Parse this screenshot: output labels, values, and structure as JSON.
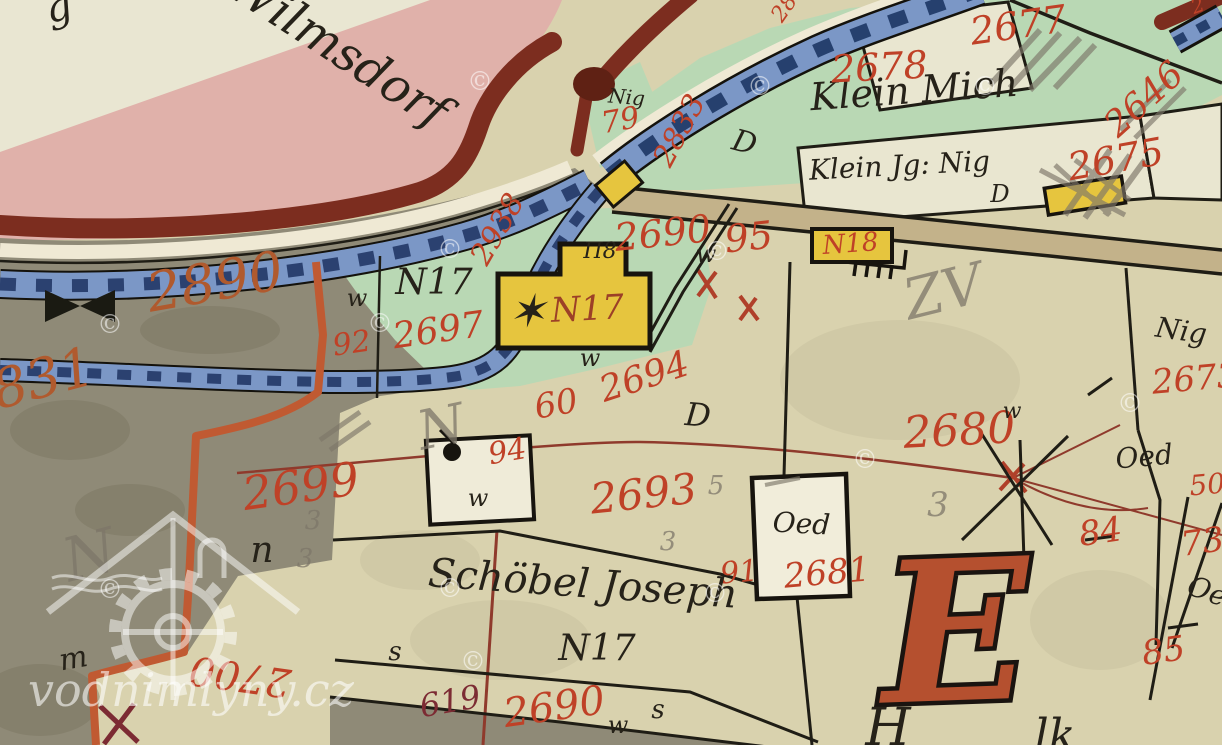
{
  "palette": {
    "parchment": "#d9d2ae",
    "parchment_light": "#e9e6d2",
    "pink": "#e0b1aa",
    "boundary_maroon": "#7c2d1f",
    "blob_brown": "#5f2114",
    "stream_blue": "#7b97c6",
    "stream_dark": "#2b4170",
    "stream_edge": "#14120c",
    "white_bank": "#efe9d4",
    "meadow_green": "#b9d8b4",
    "gray_land": "#8f8a77",
    "building_yellow": "#e6c53e",
    "building_white": "#f1edda",
    "road_tan": "#c3b28a",
    "orange_boundary": "#c05a32",
    "thin_red_line": "#8f3a2c",
    "parcel_red": "#bf4127",
    "orange_num": "#b05a2e",
    "dark_red_num": "#7c2b33",
    "red_brown": "#9c4027",
    "big_e": "#b5502f",
    "ink": "#262219",
    "pencil": "#7d7669"
  },
  "watermark": {
    "site": "vodnimlyny.cz",
    "symbol": "©",
    "positions": [
      [
        480,
        90
      ],
      [
        760,
        95
      ],
      [
        985,
        95
      ],
      [
        450,
        258
      ],
      [
        717,
        260
      ],
      [
        110,
        333
      ],
      [
        380,
        332
      ],
      [
        1130,
        412
      ],
      [
        865,
        468
      ],
      [
        450,
        597
      ],
      [
        715,
        602
      ],
      [
        110,
        598
      ],
      [
        473,
        670
      ]
    ]
  },
  "labels": [
    {
      "n": "script-fragment-top-left",
      "t": "g",
      "x": 62,
      "y": 20,
      "s": 40,
      "r": -15,
      "c": "ink"
    },
    {
      "n": "place-name-wilmsdorf",
      "t": "Wilmsdorf",
      "x": 330,
      "y": 62,
      "s": 48,
      "r": 33,
      "c": "ink"
    },
    {
      "n": "place-name-klein-mich",
      "t": "Klein Mich",
      "x": 915,
      "y": 103,
      "s": 38,
      "r": -4,
      "c": "ink"
    },
    {
      "n": "place-name-klein-jg-nig",
      "t": "Klein Jg: Nig",
      "x": 900,
      "y": 175,
      "s": 28,
      "r": -3,
      "c": "ink"
    },
    {
      "n": "letter-d-klein-parcel",
      "t": "D",
      "x": 1000,
      "y": 202,
      "s": 24,
      "r": 0,
      "c": "ink"
    },
    {
      "n": "label-nig-junction",
      "t": "Nig",
      "x": 626,
      "y": 104,
      "s": 20,
      "r": 5,
      "c": "ink"
    },
    {
      "n": "parcel-number-79",
      "t": "79",
      "x": 622,
      "y": 130,
      "s": 30,
      "r": -10,
      "c": "parcel_red"
    },
    {
      "n": "parcel-number-2833",
      "t": "2833",
      "x": 688,
      "y": 135,
      "s": 30,
      "r": -62,
      "c": "parcel_red"
    },
    {
      "n": "parcel-number-2938",
      "t": "2938",
      "x": 506,
      "y": 234,
      "s": 30,
      "r": -60,
      "c": "parcel_red"
    },
    {
      "n": "parcel-number-2677",
      "t": "2677",
      "x": 1020,
      "y": 38,
      "s": 38,
      "r": -8,
      "c": "parcel_red"
    },
    {
      "n": "parcel-number-2678",
      "t": "2678",
      "x": 880,
      "y": 80,
      "s": 38,
      "r": -3,
      "c": "parcel_red"
    },
    {
      "n": "parcel-number-2646",
      "t": "2646",
      "x": 1152,
      "y": 108,
      "s": 36,
      "r": -42,
      "c": "parcel_red"
    },
    {
      "n": "parcel-number-2675",
      "t": "2675",
      "x": 1118,
      "y": 172,
      "s": 38,
      "r": -10,
      "c": "parcel_red"
    },
    {
      "n": "letter-d-junction-meadow",
      "t": "D",
      "x": 742,
      "y": 152,
      "s": 30,
      "r": 15,
      "c": "ink"
    },
    {
      "n": "parcel-number-2690-mid",
      "t": "2690",
      "x": 664,
      "y": 246,
      "s": 38,
      "r": -6,
      "c": "parcel_red"
    },
    {
      "n": "parcel-number-95",
      "t": "95",
      "x": 750,
      "y": 250,
      "s": 38,
      "r": -6,
      "c": "parcel_red"
    },
    {
      "n": "letter-w-mid",
      "t": "w",
      "x": 706,
      "y": 262,
      "s": 24,
      "r": 0,
      "c": "ink"
    },
    {
      "n": "house-number-n18",
      "t": "N18",
      "x": 851,
      "y": 252,
      "s": 26,
      "r": -4,
      "c": "parcel_red"
    },
    {
      "n": "parcel-number-2890",
      "t": "2890",
      "x": 218,
      "y": 300,
      "s": 54,
      "r": -10,
      "c": "orange_num"
    },
    {
      "n": "parcel-number-831",
      "t": "831",
      "x": 48,
      "y": 396,
      "s": 54,
      "r": -15,
      "c": "orange_num"
    },
    {
      "n": "house-number-n17-meadow",
      "t": "N17",
      "x": 434,
      "y": 294,
      "s": 36,
      "r": 0,
      "c": "ink"
    },
    {
      "n": "parcel-number-2697",
      "t": "2697",
      "x": 440,
      "y": 342,
      "s": 36,
      "r": -8,
      "c": "parcel_red"
    },
    {
      "n": "parcel-number-92",
      "t": "92",
      "x": 353,
      "y": 353,
      "s": 30,
      "r": -8,
      "c": "parcel_red"
    },
    {
      "n": "letter-w-left",
      "t": "w",
      "x": 357,
      "y": 306,
      "s": 24,
      "r": 0,
      "c": "ink"
    },
    {
      "n": "house-star-mark",
      "t": "✶",
      "x": 527,
      "y": 327,
      "s": 46,
      "r": 0,
      "c": "ink"
    },
    {
      "n": "house-number-n17-building",
      "t": "N17",
      "x": 588,
      "y": 320,
      "s": 34,
      "r": -3,
      "c": "red_brown"
    },
    {
      "n": "house-mark-n8",
      "t": "Π8",
      "x": 600,
      "y": 258,
      "s": 22,
      "r": 0,
      "c": "ink"
    },
    {
      "n": "letter-w-below-house",
      "t": "w",
      "x": 590,
      "y": 366,
      "s": 24,
      "r": 0,
      "c": "ink"
    },
    {
      "n": "parcel-number-2694",
      "t": "2694",
      "x": 648,
      "y": 388,
      "s": 36,
      "r": -18,
      "c": "parcel_red"
    },
    {
      "n": "parcel-number-60",
      "t": "60",
      "x": 558,
      "y": 415,
      "s": 34,
      "r": -10,
      "c": "parcel_red"
    },
    {
      "n": "letter-d-2680",
      "t": "D",
      "x": 697,
      "y": 426,
      "s": 32,
      "r": 5,
      "c": "ink"
    },
    {
      "n": "parcel-number-2680",
      "t": "2680",
      "x": 960,
      "y": 445,
      "s": 44,
      "r": -3,
      "c": "parcel_red"
    },
    {
      "n": "pencil-3-2680",
      "t": "3",
      "x": 938,
      "y": 516,
      "s": 34,
      "r": 0,
      "c": "pencil",
      "cls": "pencil"
    },
    {
      "n": "pencil-n-left",
      "t": "N",
      "x": 95,
      "y": 575,
      "s": 60,
      "r": -15,
      "c": "pencil",
      "cls": "pencil"
    },
    {
      "n": "pencil-n-mid",
      "t": "N",
      "x": 445,
      "y": 445,
      "s": 54,
      "r": -12,
      "c": "pencil",
      "cls": "pencil"
    },
    {
      "n": "pencil-zv",
      "t": "ZV",
      "x": 948,
      "y": 310,
      "s": 56,
      "r": -14,
      "c": "pencil",
      "cls": "pencil"
    },
    {
      "n": "parcel-number-94",
      "t": "94",
      "x": 509,
      "y": 461,
      "s": 30,
      "r": -10,
      "c": "parcel_red"
    },
    {
      "n": "letter-w-square-building",
      "t": "w",
      "x": 478,
      "y": 506,
      "s": 24,
      "r": 0,
      "c": "ink"
    },
    {
      "n": "parcel-number-2699",
      "t": "2699",
      "x": 303,
      "y": 502,
      "s": 46,
      "r": -8,
      "c": "parcel_red"
    },
    {
      "n": "letter-n-2699",
      "t": "n",
      "x": 262,
      "y": 562,
      "s": 36,
      "r": 0,
      "c": "ink"
    },
    {
      "n": "pencil-3-a",
      "t": "3",
      "x": 313,
      "y": 529,
      "s": 26,
      "r": 0,
      "c": "pencil",
      "cls": "pencil"
    },
    {
      "n": "pencil-3-b",
      "t": "3",
      "x": 305,
      "y": 567,
      "s": 26,
      "r": 0,
      "c": "pencil",
      "cls": "pencil"
    },
    {
      "n": "pencil-3-c",
      "t": "3",
      "x": 668,
      "y": 550,
      "s": 26,
      "r": 0,
      "c": "pencil",
      "cls": "pencil"
    },
    {
      "n": "pencil-5",
      "t": "5",
      "x": 716,
      "y": 494,
      "s": 26,
      "r": 0,
      "c": "pencil",
      "cls": "pencil"
    },
    {
      "n": "parcel-number-2693",
      "t": "2693",
      "x": 645,
      "y": 508,
      "s": 42,
      "r": -6,
      "c": "parcel_red"
    },
    {
      "n": "building-label-oed",
      "t": "Oed",
      "x": 801,
      "y": 533,
      "s": 28,
      "r": 3,
      "c": "ink"
    },
    {
      "n": "parcel-number-91",
      "t": "91",
      "x": 740,
      "y": 582,
      "s": 30,
      "r": -5,
      "c": "parcel_red"
    },
    {
      "n": "parcel-number-2681",
      "t": "2681",
      "x": 828,
      "y": 584,
      "s": 34,
      "r": -5,
      "c": "parcel_red"
    },
    {
      "n": "label-oed-right",
      "t": "Oed",
      "x": 1145,
      "y": 466,
      "s": 28,
      "r": -5,
      "c": "ink"
    },
    {
      "n": "parcel-number-50",
      "t": "50",
      "x": 1208,
      "y": 494,
      "s": 28,
      "r": -5,
      "c": "parcel_red"
    },
    {
      "n": "label-nig-right",
      "t": "Nig",
      "x": 1180,
      "y": 340,
      "s": 28,
      "r": 8,
      "c": "ink"
    },
    {
      "n": "parcel-number-2673",
      "t": "2673",
      "x": 1196,
      "y": 390,
      "s": 34,
      "r": -5,
      "c": "parcel_red"
    },
    {
      "n": "parcel-number-84",
      "t": "84",
      "x": 1102,
      "y": 543,
      "s": 34,
      "r": -8,
      "c": "parcel_red"
    },
    {
      "n": "parcel-number-73",
      "t": "73",
      "x": 1204,
      "y": 553,
      "s": 34,
      "r": -8,
      "c": "parcel_red"
    },
    {
      "n": "label-oe-right-lower",
      "t": "Oe",
      "x": 1204,
      "y": 600,
      "s": 28,
      "r": 20,
      "c": "ink"
    },
    {
      "n": "parcel-number-85",
      "t": "85",
      "x": 1165,
      "y": 662,
      "s": 34,
      "r": -8,
      "c": "parcel_red"
    },
    {
      "n": "owner-name-schoebel-joseph",
      "t": "Schöbel Joseph",
      "x": 582,
      "y": 597,
      "s": 40,
      "r": 4,
      "c": "ink"
    },
    {
      "n": "house-number-n17-schoebel",
      "t": "N17",
      "x": 597,
      "y": 660,
      "s": 36,
      "r": 0,
      "c": "ink"
    },
    {
      "n": "parcel-number-619",
      "t": "619",
      "x": 452,
      "y": 712,
      "s": 32,
      "r": -10,
      "c": "dark_red_num"
    },
    {
      "n": "parcel-number-2690-bottom",
      "t": "2690",
      "x": 556,
      "y": 720,
      "s": 40,
      "r": -8,
      "c": "parcel_red"
    },
    {
      "n": "letter-w-bottom",
      "t": "w",
      "x": 618,
      "y": 733,
      "s": 24,
      "r": 0,
      "c": "ink"
    },
    {
      "n": "letter-s-bottom",
      "t": "s",
      "x": 658,
      "y": 718,
      "s": 26,
      "r": 0,
      "c": "ink"
    },
    {
      "n": "letter-s-left-bottom",
      "t": "s",
      "x": 395,
      "y": 660,
      "s": 26,
      "r": 0,
      "c": "ink"
    },
    {
      "n": "letter-m-gray-corner",
      "t": "m",
      "x": 75,
      "y": 668,
      "s": 30,
      "r": -10,
      "c": "ink"
    },
    {
      "n": "parcel-number-2700",
      "t": "2700",
      "x": 242,
      "y": 663,
      "s": 40,
      "r": 188,
      "c": "parcel_red"
    },
    {
      "n": "section-letter-e",
      "t": "E",
      "x": 958,
      "y": 700,
      "s": 195,
      "r": -2,
      "c": "big_e",
      "cls": "bigE"
    },
    {
      "n": "script-fragment-h",
      "t": "H",
      "x": 888,
      "y": 745,
      "s": 52,
      "r": 0,
      "c": "ink"
    },
    {
      "n": "script-fragment-k",
      "t": "lk",
      "x": 1055,
      "y": 750,
      "s": 44,
      "r": 0,
      "c": "ink"
    },
    {
      "n": "letter-w-2680-node",
      "t": "w",
      "x": 1012,
      "y": 418,
      "s": 22,
      "r": 0,
      "c": "ink"
    },
    {
      "n": "red-fragment-top",
      "t": "28",
      "x": 790,
      "y": 12,
      "s": 22,
      "r": -55,
      "c": "parcel_red"
    },
    {
      "n": "red-fragment-corner",
      "t": "2",
      "x": 1200,
      "y": 12,
      "s": 20,
      "r": -20,
      "c": "parcel_red"
    }
  ]
}
